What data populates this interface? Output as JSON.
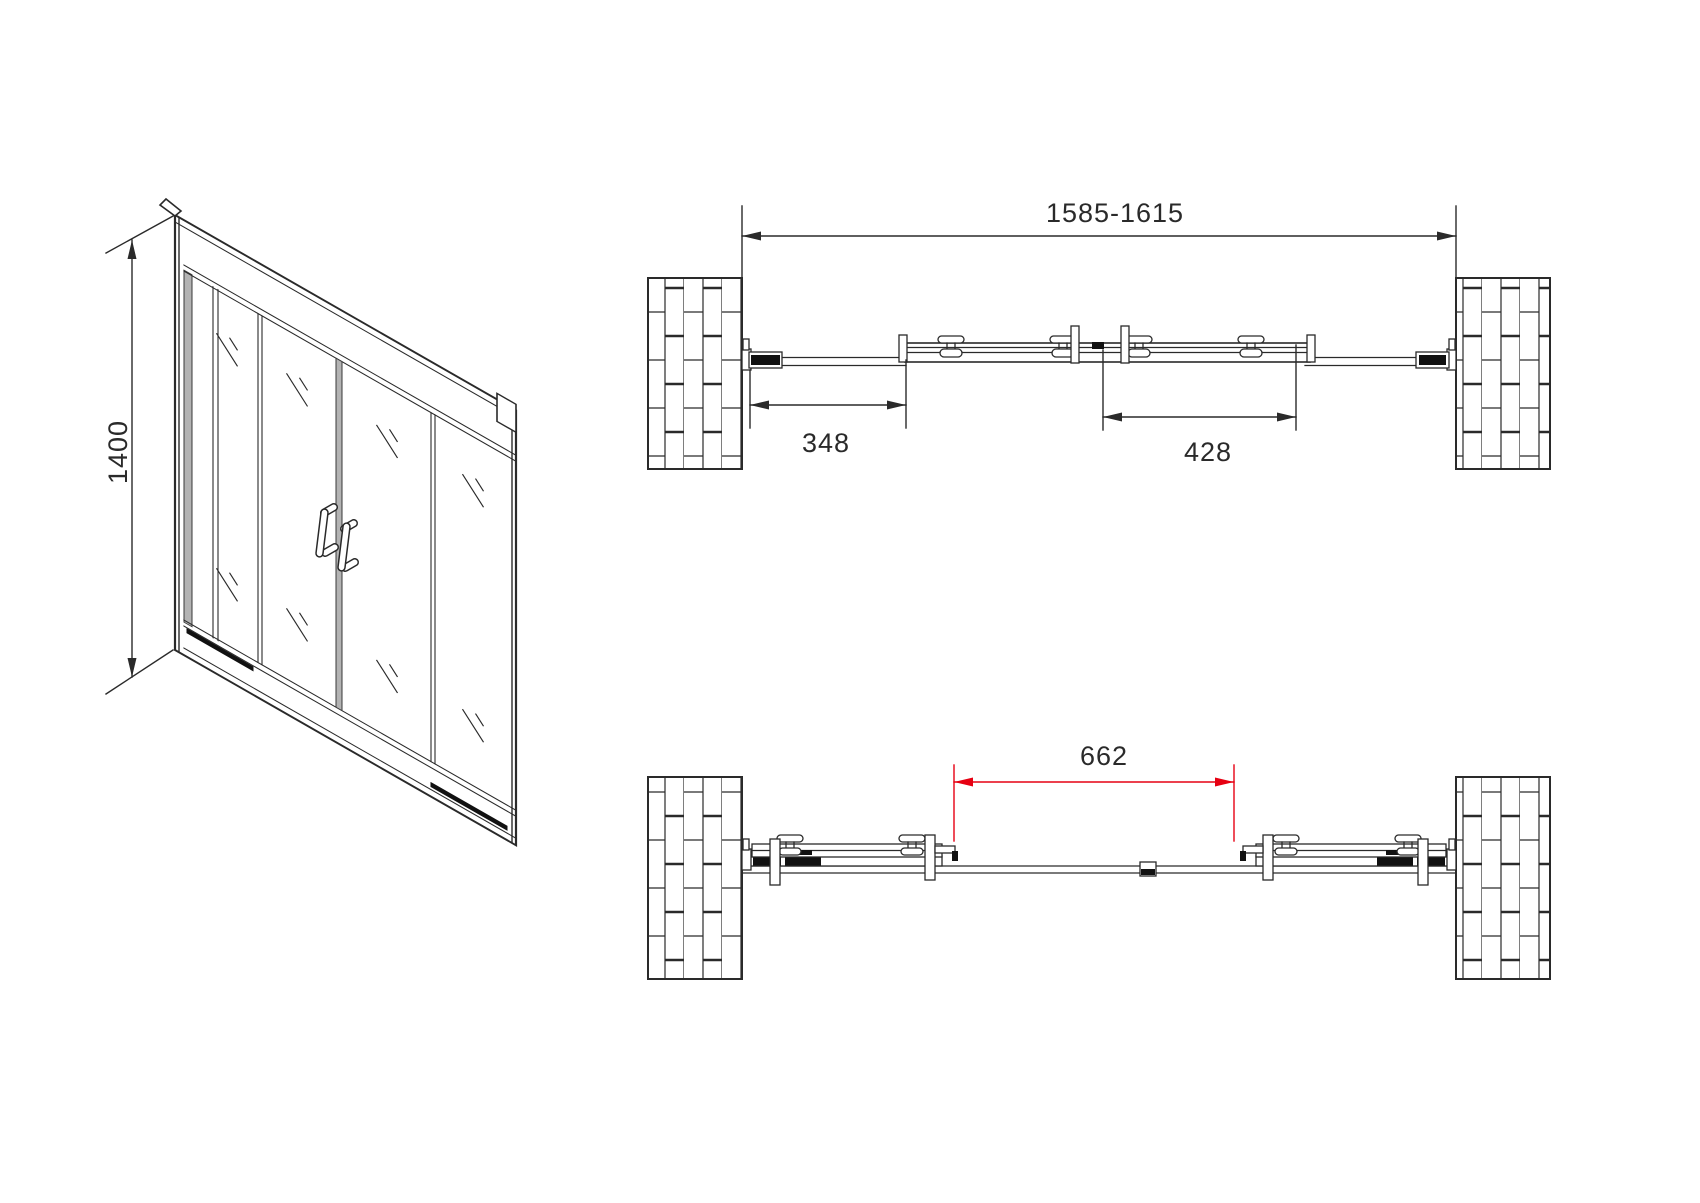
{
  "drawing": {
    "isometric_view": {
      "height_dimension": "1400"
    },
    "plan_view_closed": {
      "overall_width_dimension": "1585-1615",
      "left_opening_dimension": "348",
      "right_opening_dimension": "428"
    },
    "plan_view_open": {
      "slide_opening_dimension": "662"
    }
  },
  "colors": {
    "line": "#2a2a2a",
    "dark_fill": "#111111",
    "profile_gray": "#b3b3b3",
    "dimension_red": "#e60012",
    "background": "#ffffff"
  }
}
